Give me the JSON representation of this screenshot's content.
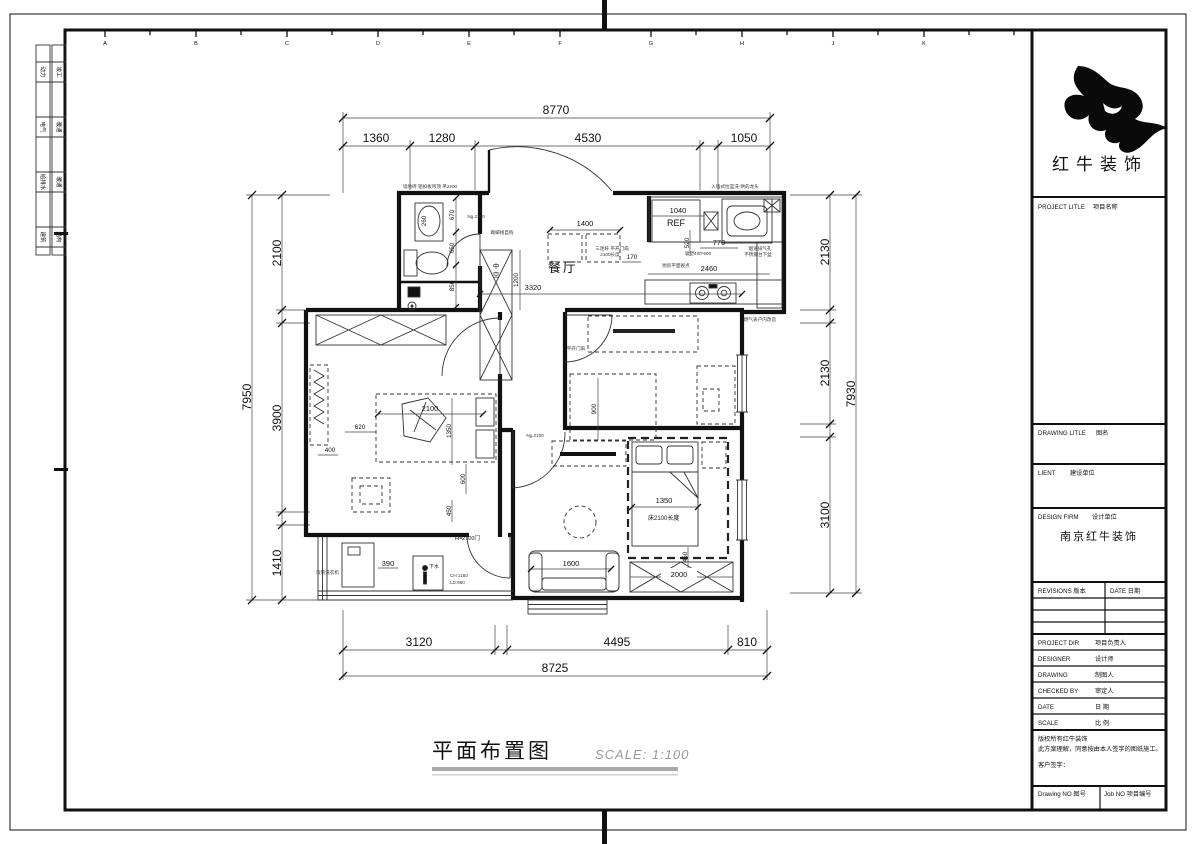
{
  "sheet": {
    "grid_letters": [
      "A",
      "B",
      "C",
      "D",
      "E",
      "F",
      "G",
      "H",
      "J",
      "K"
    ],
    "stamps": [
      {
        "a": "动力",
        "b": "竣工"
      },
      {
        "a": "电气",
        "b": "暖通"
      },
      {
        "a": "给排水",
        "b": "暖通"
      },
      {
        "a": "建筑",
        "b": "结构"
      }
    ]
  },
  "title_block": {
    "brand": "红牛装饰",
    "project": {
      "en": "PROJECT LITLE",
      "cn": "项目名称"
    },
    "drawing_title": {
      "en": "DRAWING LITLE",
      "cn": "图名"
    },
    "client": {
      "en": "LIENT",
      "cn": "建设单位"
    },
    "design_firm": {
      "en": "DESIGN FIRM",
      "cn": "设计单位",
      "value": "南京红牛装饰"
    },
    "revisions": {
      "label": "REVISIONS 版本",
      "date": "DATE 日期"
    },
    "rows": [
      {
        "en": "PROJECT DIR",
        "cn": "项目负责人"
      },
      {
        "en": "DESIGNER",
        "cn": "设计师"
      },
      {
        "en": "DRAWING",
        "cn": "制图人"
      },
      {
        "en": "CHECKED BY",
        "cn": "审定人"
      },
      {
        "en": "DATE",
        "cn": "日 期"
      },
      {
        "en": "SCALE",
        "cn": "比 例"
      }
    ],
    "copyright1": "版权所有红牛装饰",
    "copyright2": "此方案理解，同意按由本人签字的图纸施工。",
    "sign": "客户签字：",
    "drawing_no": "Drawing NO 图号",
    "job_no": "Job NO 项目编号"
  },
  "footer": {
    "title": "平面布置图",
    "scale": "SCALE: 1:100"
  },
  "plan": {
    "labels": {
      "dining": "餐厅",
      "void1": "中",
      "void2": "空",
      "fridge": "REF",
      "bed_note": "床2100长度",
      "door_note": "H=2100门",
      "drain": "下水"
    },
    "dims": {
      "top_total": "8770",
      "top1": "1360",
      "top2": "1280",
      "top3": "4530",
      "top4": "1050",
      "left_total": "7950",
      "left1": "2100",
      "left2": "3900",
      "left3": "1410",
      "right1": "2130",
      "right2": "2130",
      "right3": "3100",
      "right_total": "7930",
      "bottom1": "3120",
      "bottom2": "4495",
      "bottom3": "810",
      "bottom_total": "8725",
      "bath1": "670",
      "bath2": "650",
      "bath3": "850",
      "basin": "260",
      "table": "1400",
      "void_h": "1200",
      "dining_span": "3320",
      "entry": "170",
      "ref": "1040",
      "k1": "520",
      "k2": "770",
      "k3": "2460",
      "bed1_w": "2100",
      "bed1_h": "1350",
      "b620": "620",
      "b400": "400",
      "b600": "600",
      "b450": "450",
      "mid": "900",
      "sofa": "1600",
      "bed2_w": "1350",
      "b450b": "450",
      "wardrobe": "2000",
      "balcony": "390"
    },
    "notes": {
      "bath_top": "墙地砖 铝扣板吊顶 吊2200",
      "kitchen_top": "入墙式拉篮洗-烘的龙头",
      "skirting": "踢脚线自购",
      "entry_door": "三连杆 平开门扇",
      "entry_door2": "2100长度",
      "cabinet": "吸塑400*600",
      "kitchen_view": "厨房平面视点",
      "vent": "烟道排气孔",
      "sink_note": "不锈钢台下盆",
      "gas": "燃气表户内改造",
      "washer": "滚筒洗衣机",
      "ch": "CH:1150",
      "ld": "LD:960",
      "ng": "Ng.2100",
      "mid_door": "平开门扇"
    }
  }
}
